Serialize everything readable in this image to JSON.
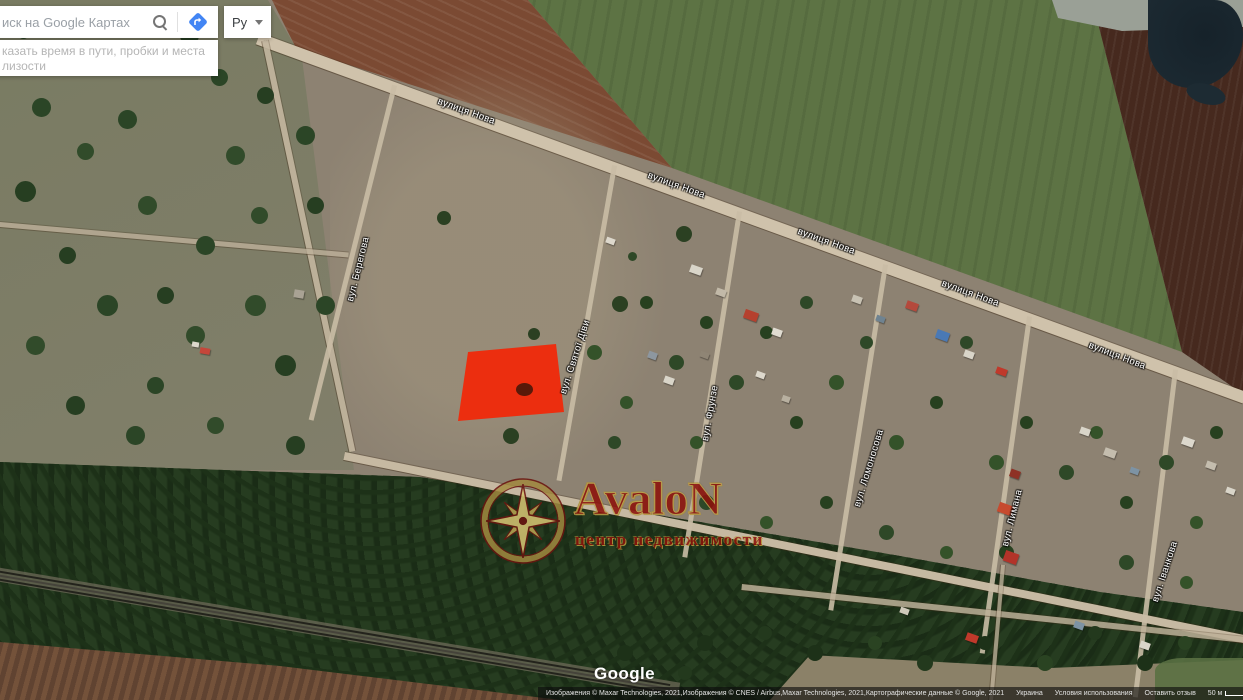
{
  "header": {
    "search_placeholder": "иск на Google Картах",
    "lang_label": "Ру",
    "hint_line1": "казать время в пути, пробки и места",
    "hint_line2": "лизости"
  },
  "icons": {
    "search": "magnifier",
    "directions": "blue-diamond-turn-arrow",
    "language_caret": "chevron-down"
  },
  "map": {
    "highlight_color": "#f32606",
    "road_labels": [
      "вулиця Нова",
      "вулиця Нова",
      "вулиця Нова",
      "вулиця Нова",
      "вулиця Нова"
    ],
    "street_labels": [
      "вул. Берегова",
      "вул. Святої Діви",
      "вул. Фрунзе",
      "вул. Ломоносова",
      "вул. Лимана",
      "вул. Іванкова"
    ]
  },
  "watermark": {
    "title": "AvaloN",
    "subtitle": "центр недвижимости"
  },
  "footer": {
    "logo": "Google",
    "attribution": "Изображения © Maxar Technologies, 2021,Изображения © CNES / Airbus,Maxar Technologies, 2021,Картографические данные © Google, 2021",
    "links": [
      "Украина",
      "Условия использования",
      "Оставить отзыв"
    ],
    "scale_label": "50 м"
  }
}
